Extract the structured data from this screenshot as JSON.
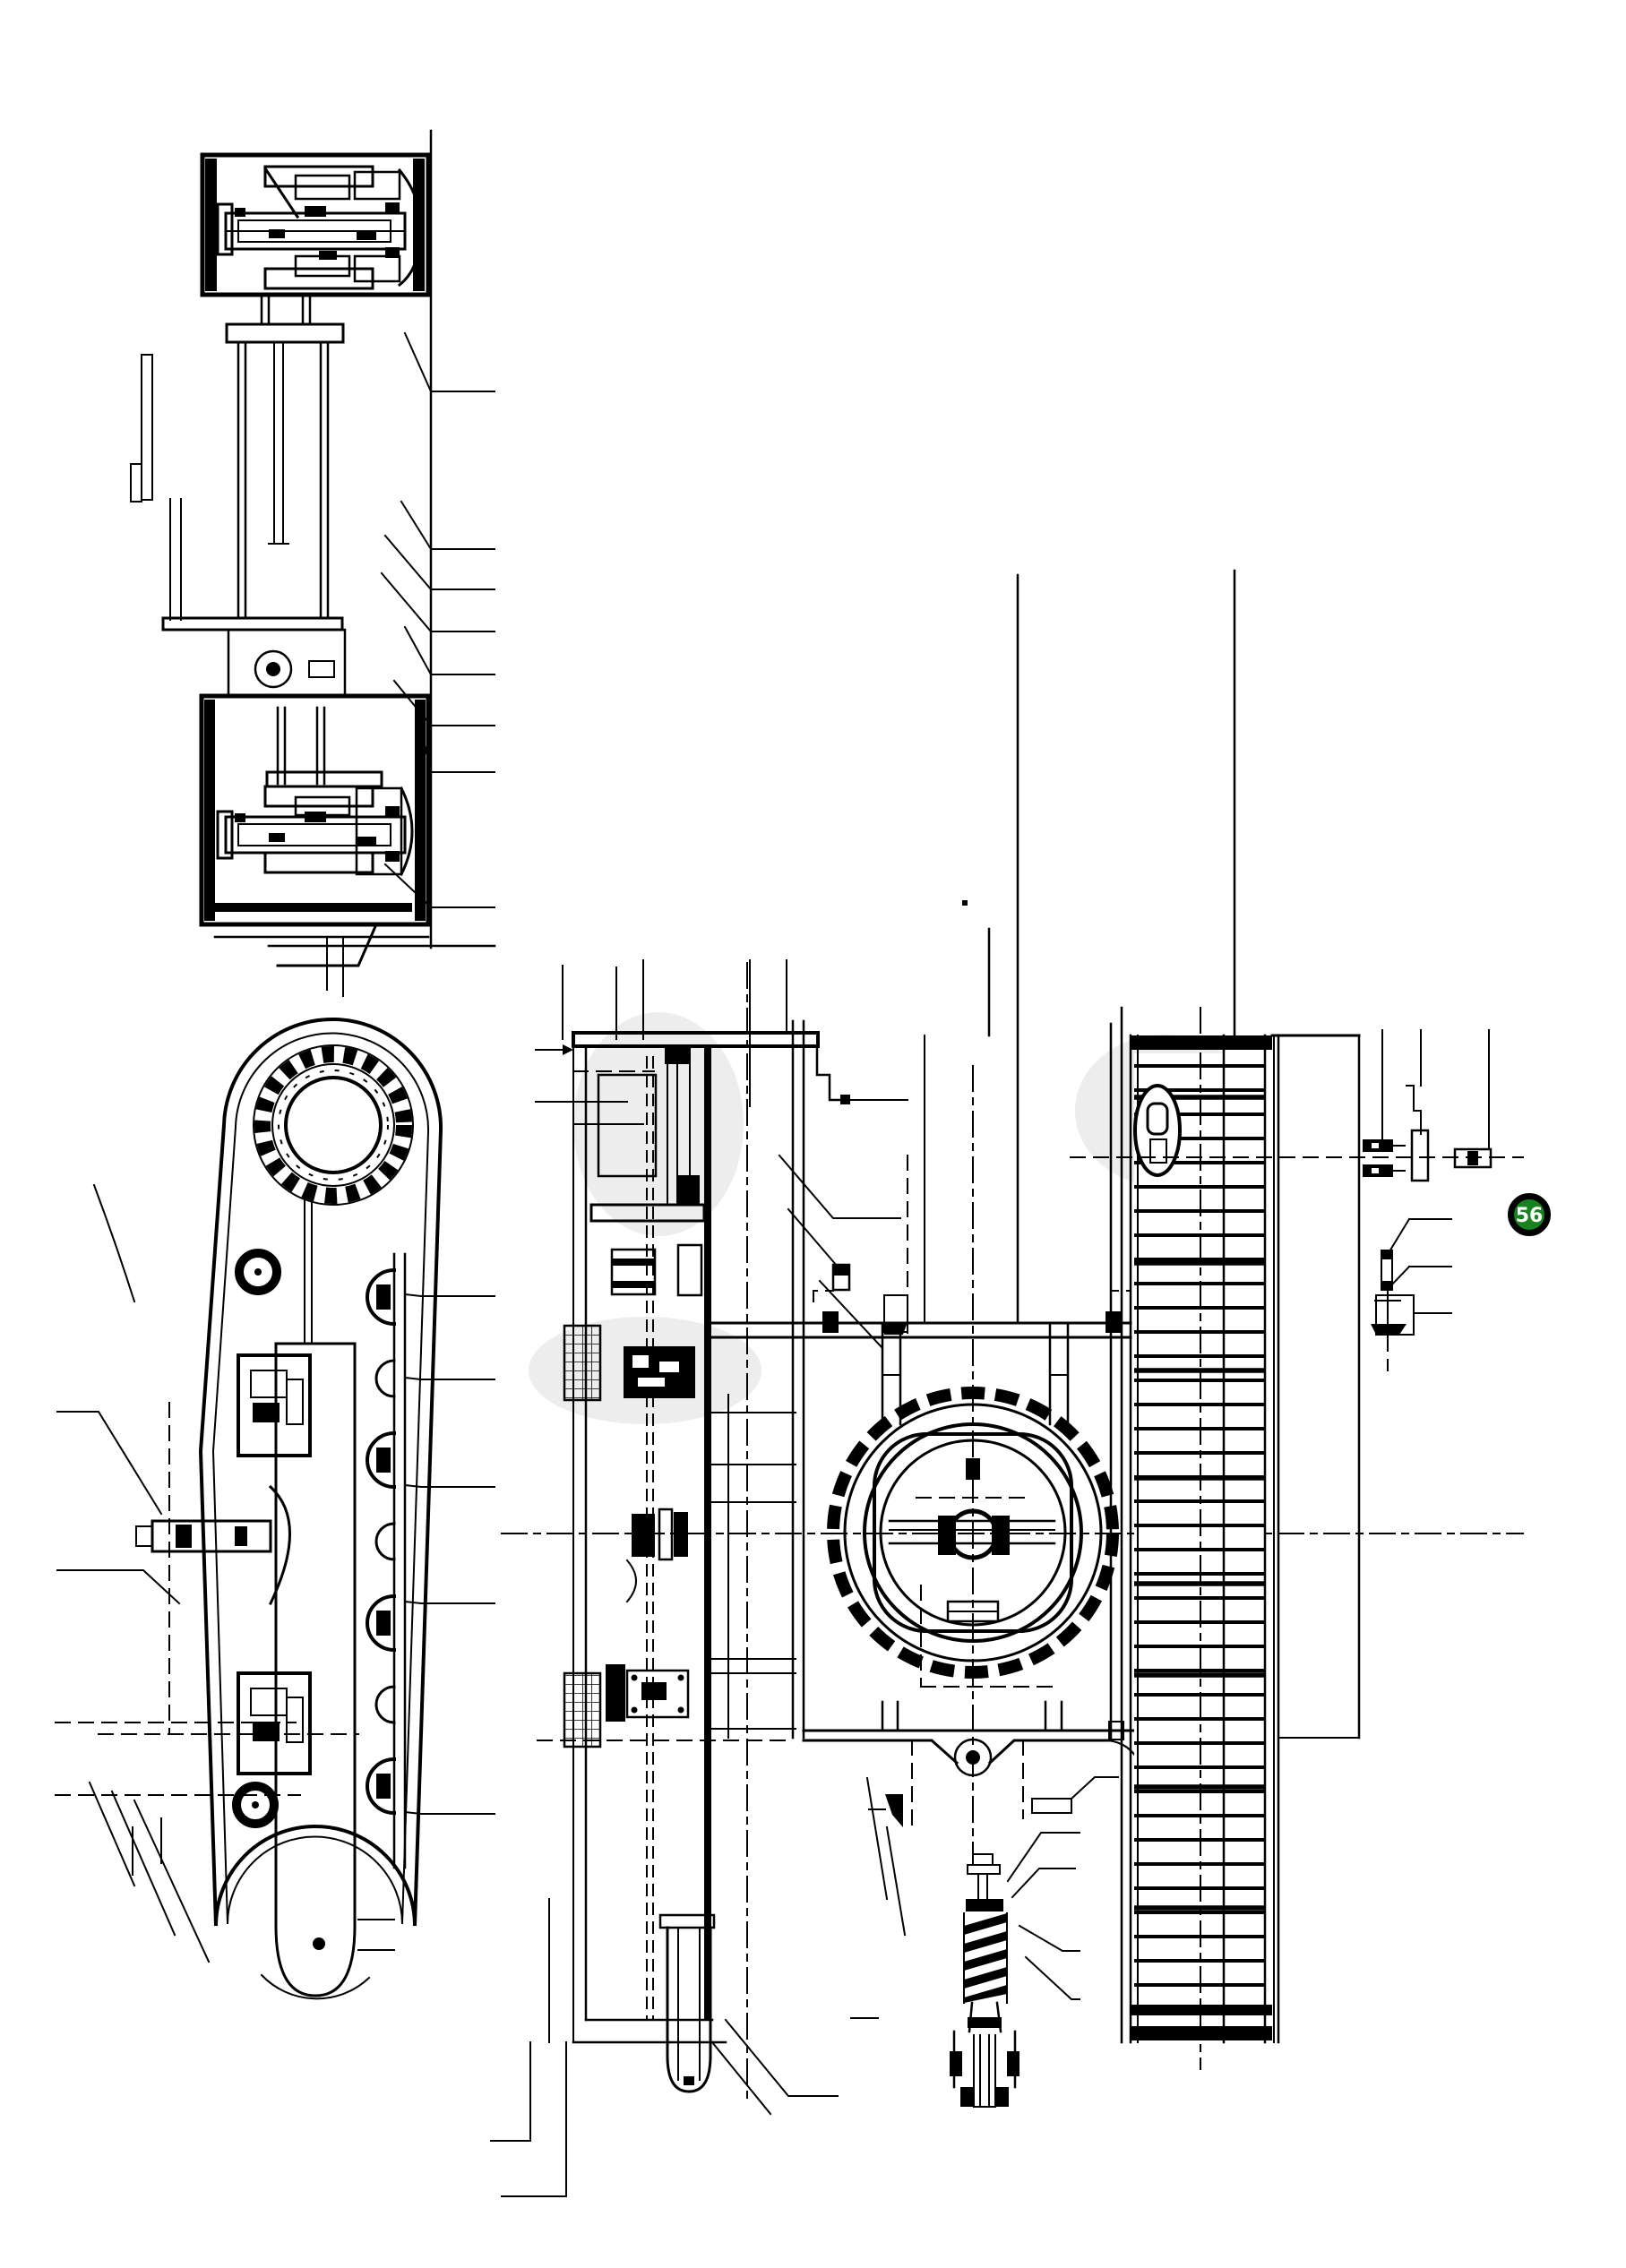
{
  "document": {
    "kind": "undercarriage parts diagram",
    "background": "#ffffff",
    "ink": "#000000"
  },
  "callout": {
    "number": "56",
    "fill": "#17821e",
    "ring_color": "#000000",
    "text_color": "#ffffff"
  },
  "views": {
    "section_a": "travel drive cross-section",
    "side": "crawler track side view",
    "section_b": "track frame longitudinal section",
    "plan": "undercarriage plan view with swing circle",
    "detail": "recoil spring detail"
  }
}
